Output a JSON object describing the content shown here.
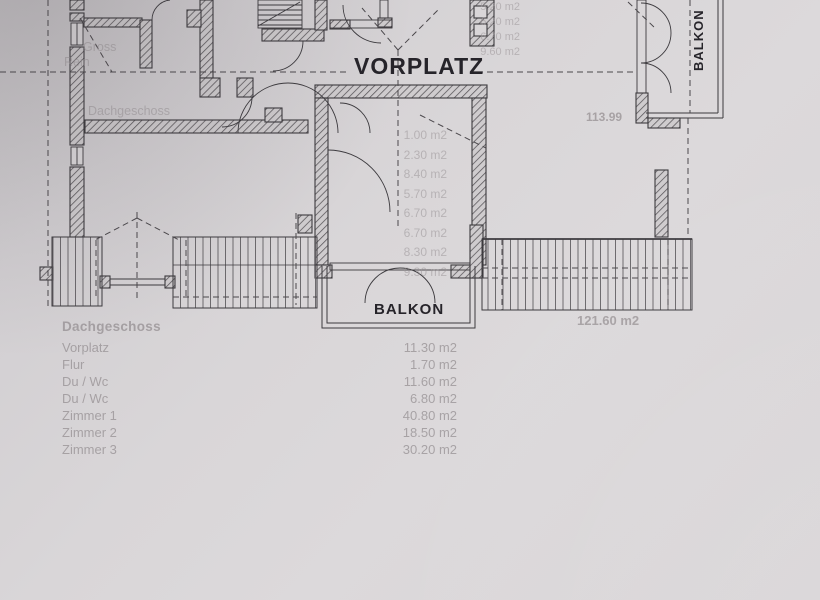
{
  "plan": {
    "labels": {
      "vorplatz": "VORPLATZ",
      "balkon_bottom": "BALKON",
      "balkon_right": "BALKON"
    },
    "faint_totals": {
      "upper_right": "113.99",
      "lower_right": "121.60 m2"
    },
    "faint_center_areas": [
      "1.00 m2",
      "2.30 m2",
      "8.40 m2",
      "5.70 m2",
      "6.70 m2",
      "6.70 m2",
      "8.30 m2",
      "9.30 m2"
    ],
    "faint_top_areas": [
      "5.20 m2",
      "6.20 m2",
      "6.70 m2",
      "9.60 m2"
    ],
    "faint_left_fragments": [
      "Gross",
      "Rein",
      "Dachgeschoss"
    ],
    "room_table": {
      "header": "Dachgeschoss",
      "rows": [
        {
          "name": "Vorplatz",
          "area": "11.30 m2"
        },
        {
          "name": "Flur",
          "area": "1.70 m2"
        },
        {
          "name": "Du / Wc",
          "area": "11.60 m2"
        },
        {
          "name": "Du / Wc",
          "area": "6.80 m2"
        },
        {
          "name": "Zimmer 1",
          "area": "40.80 m2"
        },
        {
          "name": "Zimmer 2",
          "area": "18.50 m2"
        },
        {
          "name": "Zimmer 3",
          "area": "30.20 m2"
        }
      ]
    },
    "colors": {
      "paper": "#d9d6d8",
      "ink": "#3c3a3e",
      "faint_text": "#9b9598"
    }
  }
}
